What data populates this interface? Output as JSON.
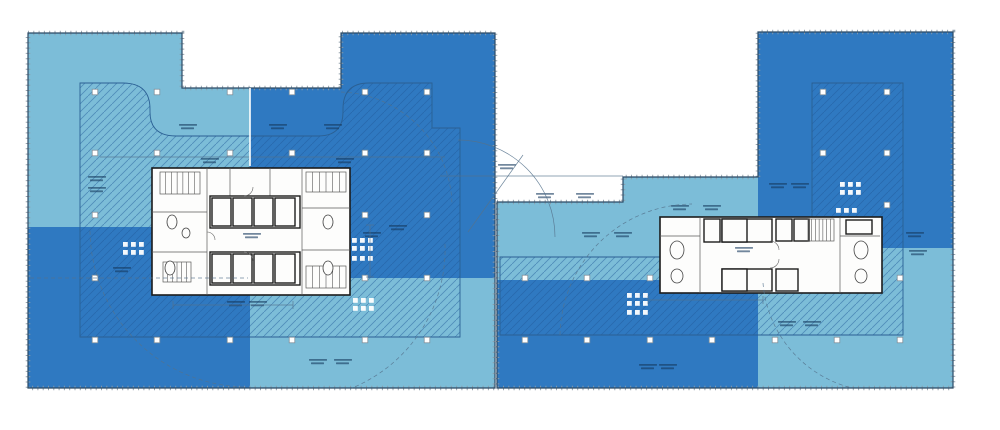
{
  "document": {
    "kind": "architectural-floor-plan",
    "description": "Two-tower office floor plate with light/dark blue lease zones, hatched lease-span areas, white service cores, column grid and mullion-ticked perimeter",
    "legible_text": false
  },
  "colors": {
    "background": "#ffffff",
    "zone_light": "#7cbdd8",
    "zone_dark": "#2f79c1",
    "hatch_line": "#1f5a99",
    "hatch_border": "#2b6094",
    "outline": "#2b4a66",
    "tick": "#8d9ba6",
    "core_fill": "#fdfdfc",
    "core_line": "#1c1c1c",
    "partition_line": "#5a5a5a",
    "annotation": "#16395e",
    "column_fill": "#ffffff",
    "column_border": "#7f8f9b",
    "extras_line": "#55728c",
    "zone_split_line": "#ffffff"
  },
  "plan": {
    "buildings": [
      {
        "id": "west-tower",
        "outline": "M28,33 H182 V88 H341 V33 H495 V388 H28 Z",
        "zones": [
          {
            "shade": "light",
            "rect": [
              28,
              33,
              222,
              194
            ]
          },
          {
            "shade": "dark",
            "rect": [
              250,
              33,
              245,
              245
            ]
          },
          {
            "shade": "dark",
            "rect": [
              28,
              227,
              222,
              161
            ]
          },
          {
            "shade": "light",
            "rect": [
              250,
              278,
              245,
              110
            ]
          }
        ],
        "hatch": "M80,83 L123,83 Q150,83 150,109 L150,112 Q150,136 176,136 L318,136 Q343,136 343,112 L343,109 Q343,83 369,83 L432,83 L432,128 L460,128 L460,337 L80,337 Z",
        "columns": [
          [
            95,
            92
          ],
          [
            157,
            92
          ],
          [
            230,
            92
          ],
          [
            292,
            92
          ],
          [
            365,
            92
          ],
          [
            427,
            92
          ],
          [
            95,
            153
          ],
          [
            157,
            153
          ],
          [
            230,
            153
          ],
          [
            292,
            153
          ],
          [
            365,
            153
          ],
          [
            427,
            153
          ],
          [
            95,
            215
          ],
          [
            365,
            215
          ],
          [
            427,
            215
          ],
          [
            95,
            278
          ],
          [
            365,
            278
          ],
          [
            427,
            278
          ],
          [
            95,
            340
          ],
          [
            157,
            340
          ],
          [
            230,
            340
          ],
          [
            292,
            340
          ],
          [
            365,
            340
          ],
          [
            427,
            340
          ]
        ],
        "clusters": [
          [
            123,
            242,
            2,
            3
          ],
          [
            352,
            238,
            2,
            3
          ],
          [
            352,
            256,
            1,
            3
          ],
          [
            353,
            298,
            2,
            3
          ]
        ],
        "labels": [
          [
            188,
            128
          ],
          [
            278,
            128
          ],
          [
            333,
            128
          ],
          [
            97,
            180
          ],
          [
            97,
            191
          ],
          [
            122,
            271
          ],
          [
            210,
            162
          ],
          [
            345,
            162
          ],
          [
            372,
            236
          ],
          [
            398,
            229
          ],
          [
            236,
            305
          ],
          [
            258,
            305
          ],
          [
            318,
            363
          ],
          [
            343,
            363
          ],
          [
            252,
            237
          ],
          [
            507,
            168
          ]
        ],
        "core": {
          "rect": [
            152,
            168,
            198,
            127
          ],
          "partitions": [
            [
              207,
              168,
              207,
              295
            ],
            [
              302,
              168,
              302,
              295
            ],
            [
              152,
              212,
              207,
              212
            ],
            [
              152,
              252,
              207,
              252
            ],
            [
              302,
              208,
              350,
              208
            ],
            [
              302,
              250,
              350,
              250
            ],
            [
              230,
              168,
              230,
              196
            ],
            [
              270,
              168,
              270,
              196
            ],
            [
              210,
              285,
              300,
              285
            ]
          ],
          "cells": [
            [
              210,
              196,
              90,
              32
            ],
            [
              212,
              198,
              19,
              28
            ],
            [
              233,
              198,
              19,
              28
            ],
            [
              254,
              198,
              19,
              28
            ],
            [
              275,
              198,
              20,
              28
            ],
            [
              210,
              252,
              90,
              33
            ],
            [
              212,
              254,
              19,
              29
            ],
            [
              233,
              254,
              19,
              29
            ],
            [
              254,
              254,
              19,
              29
            ],
            [
              275,
              254,
              20,
              29
            ]
          ],
          "ovals": [
            [
              172,
              222,
              5,
              7
            ],
            [
              186,
              233,
              4,
              5
            ],
            [
              170,
              268,
              5,
              7
            ],
            [
              328,
              222,
              5,
              7
            ],
            [
              328,
              268,
              5,
              7
            ]
          ],
          "stairs": [
            [
              160,
              172,
              40,
              22,
              6
            ],
            [
              306,
              172,
              40,
              20,
              5
            ],
            [
              163,
              262,
              28,
              20,
              5
            ],
            [
              306,
              266,
              40,
              22,
              5
            ]
          ],
          "doors": [
            "M244,196 A9,9 0 0 0 253,187",
            "M244,252 A9,9 0 0 1 253,261",
            "M207,232 A8,8 0 0 1 215,240"
          ]
        }
      },
      {
        "id": "east-tower",
        "outline": "M497,202 H623 V177 H758 V32 H953 V388 H497 Z",
        "zones": [
          {
            "shade": "light",
            "rect": [
              497,
              177,
              261,
              103
            ]
          },
          {
            "shade": "dark",
            "rect": [
              497,
              280,
              266,
              108
            ]
          },
          {
            "shade": "dark",
            "rect": [
              758,
              32,
              195,
              216
            ]
          },
          {
            "shade": "light",
            "rect": [
              758,
              248,
              195,
              140
            ]
          }
        ],
        "hatch": "M500,257 L812,257 L812,83 L903,83 L903,335 L500,335 Z",
        "columns": [
          [
            823,
            92
          ],
          [
            887,
            92
          ],
          [
            823,
            153
          ],
          [
            887,
            153
          ],
          [
            887,
            205
          ],
          [
            525,
            278
          ],
          [
            587,
            278
          ],
          [
            650,
            278
          ],
          [
            900,
            278
          ],
          [
            525,
            340
          ],
          [
            587,
            340
          ],
          [
            650,
            340
          ],
          [
            712,
            340
          ],
          [
            775,
            340
          ],
          [
            837,
            340
          ],
          [
            900,
            340
          ]
        ],
        "clusters": [
          [
            627,
            293,
            2,
            3
          ],
          [
            627,
            310,
            1,
            3
          ],
          [
            840,
            182,
            2,
            3
          ],
          [
            836,
            208,
            1,
            3
          ]
        ],
        "labels": [
          [
            545,
            197
          ],
          [
            585,
            197
          ],
          [
            680,
            209
          ],
          [
            712,
            209
          ],
          [
            591,
            236
          ],
          [
            623,
            236
          ],
          [
            915,
            236
          ],
          [
            918,
            254
          ],
          [
            787,
            325
          ],
          [
            812,
            325
          ],
          [
            648,
            368
          ],
          [
            668,
            368
          ],
          [
            744,
            251
          ],
          [
            778,
            187
          ],
          [
            800,
            187
          ]
        ],
        "core": {
          "rect": [
            660,
            217,
            222,
            76
          ],
          "partitions": [
            [
              700,
              217,
              700,
              293
            ],
            [
              840,
              217,
              840,
              293
            ],
            [
              660,
              236,
              700,
              236
            ],
            [
              840,
              236,
              880,
              236
            ]
          ],
          "cells": [
            [
              722,
              219,
              50,
              23
            ],
            [
              722,
              219,
              25,
              23
            ],
            [
              704,
              219,
              16,
              23
            ],
            [
              776,
              219,
              16,
              22
            ],
            [
              794,
              219,
              15,
              22
            ],
            [
              722,
              269,
              50,
              22
            ],
            [
              722,
              269,
              25,
              22
            ],
            [
              776,
              269,
              22,
              22
            ],
            [
              846,
              220,
              26,
              14
            ]
          ],
          "ovals": [
            [
              677,
              250,
              7,
              9
            ],
            [
              677,
              276,
              6,
              7
            ],
            [
              861,
              250,
              7,
              9
            ],
            [
              861,
              276,
              6,
              7
            ]
          ],
          "stairs": [
            [
              808,
              219,
              26,
              22,
              6
            ]
          ],
          "doors": [
            "M770,241 A9,9 0 0 1 779,250",
            "M770,268 A9,9 0 0 0 779,259"
          ]
        }
      }
    ],
    "extras": {
      "lines": [
        {
          "p": [
            440,
            176,
            623,
            176
          ],
          "dash": 0
        },
        {
          "p": [
            468,
            232,
            523,
            155
          ],
          "dash": 0
        },
        {
          "p": [
            100,
            157,
            445,
            157
          ],
          "dash": 0
        },
        {
          "p": [
            173,
            305,
            293,
            305
          ],
          "dash": 0
        },
        {
          "p": [
            173,
            301,
            173,
            309
          ],
          "dash": 0
        },
        {
          "p": [
            293,
            301,
            293,
            309
          ],
          "dash": 0
        },
        {
          "p": [
            370,
            225,
            370,
            277
          ],
          "dash": 0
        },
        {
          "p": [
            366,
            225,
            374,
            225
          ],
          "dash": 0
        },
        {
          "p": [
            366,
            277,
            374,
            277
          ],
          "dash": 0
        },
        {
          "p": [
            648,
            300,
            763,
            300
          ],
          "dash": 0
        },
        {
          "p": [
            648,
            296,
            648,
            304
          ],
          "dash": 0
        },
        {
          "p": [
            763,
            296,
            763,
            304
          ],
          "dash": 0
        },
        {
          "p": [
            30,
            278,
            248,
            278
          ],
          "dash": 1
        }
      ],
      "white_lines": [
        {
          "p": [
            250,
            88,
            250,
            166
          ]
        }
      ],
      "arcs": [
        {
          "d": "M458,140 A97,97 0 0 1 555,237",
          "dash": 0
        },
        {
          "d": "M90,231 A158,158 0 0 0 246,387",
          "dash": 1
        },
        {
          "d": "M341,92 A115,115 0 0 1 452,205",
          "dash": 1
        },
        {
          "d": "M560,335 A133,133 0 0 1 692,204",
          "dash": 1
        },
        {
          "d": "M763,283 A118,118 0 0 0 852,388",
          "dash": 1
        },
        {
          "d": "M445,244 A150,150 0 0 1 352,388",
          "dash": 1
        }
      ]
    }
  }
}
